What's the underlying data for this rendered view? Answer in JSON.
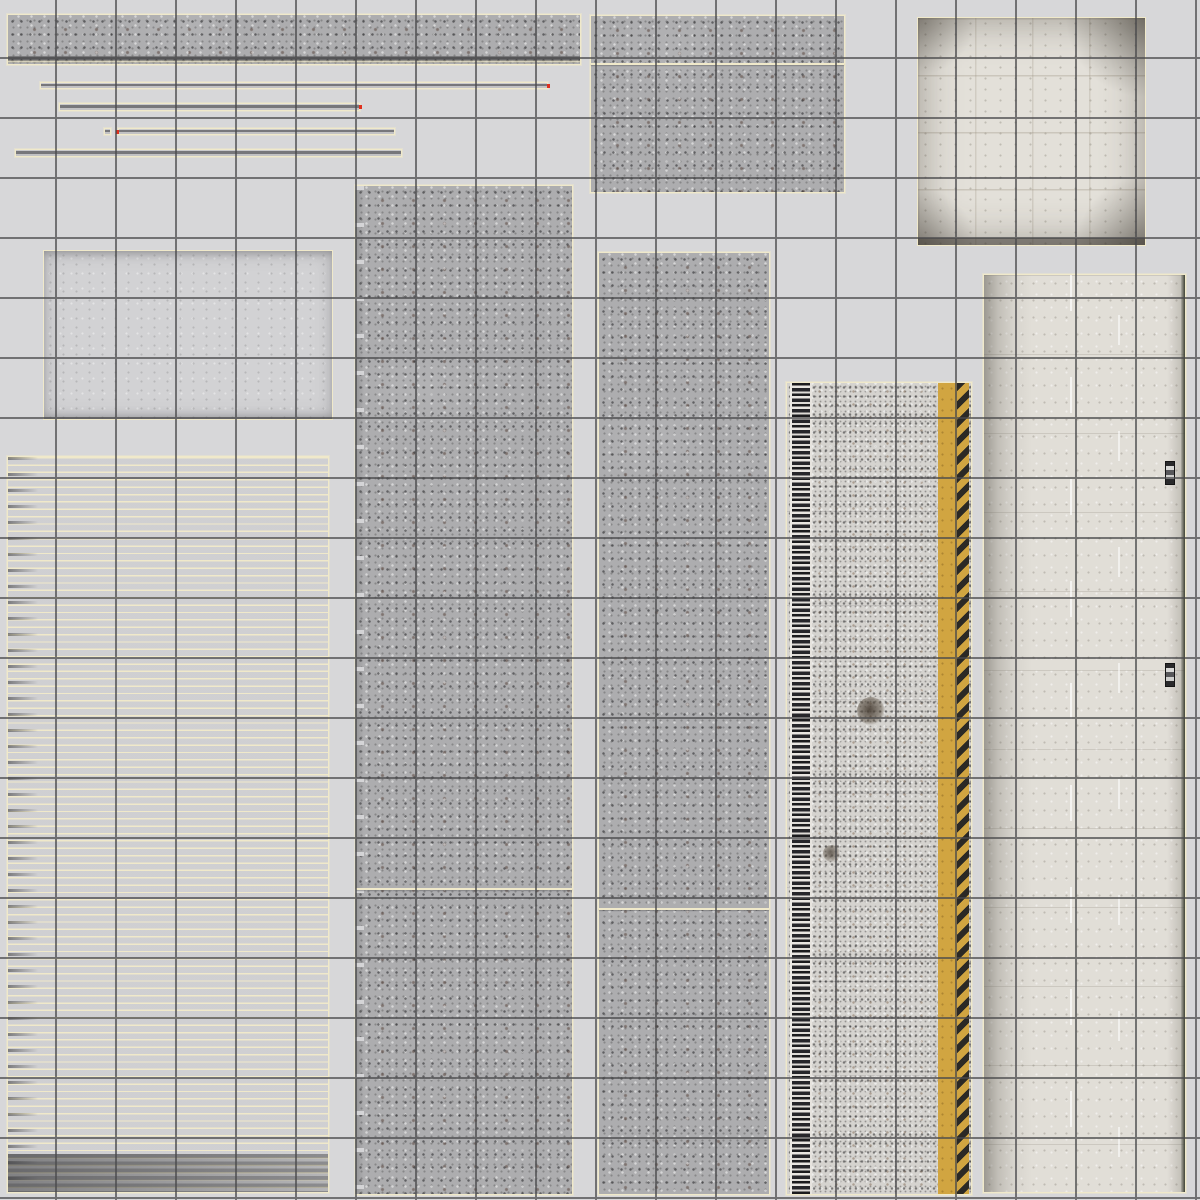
{
  "meta": {
    "type": "texture-atlas",
    "description": "UV texture atlas sheet: concrete barrier, asphalt road and runway-slab textures laid out as outlined islands over a light gray sheet with a dark square reference grid drawn on top. No text is visible in the image.",
    "palette": {
      "background": "#d7d7d9",
      "grid_line": "#4a4a4c",
      "uv_border": "#f0e9ca",
      "seam_tick": "#e0301e",
      "concrete": "#adadaf",
      "concrete_light": "#d2d2d4",
      "block_white": "#e3e0d9",
      "asphalt": "#d5d3cf",
      "paint_yellow": "#d1a541",
      "hazard_black": "#2b2925",
      "edge_green": "#3f4336"
    }
  },
  "grid": {
    "spacing": 60,
    "offset_x": 55,
    "offset_y": 57,
    "line_width": 2
  },
  "islands": [
    {
      "id": "concrete-strip-long-top",
      "texture": "concrete",
      "x": 7,
      "y": 14,
      "w": 574,
      "h": 51,
      "features": [
        "bottom-band"
      ]
    },
    {
      "id": "concrete-block-top-middle",
      "texture": "concrete",
      "x": 590,
      "y": 15,
      "w": 255,
      "h": 178,
      "features": [
        "divider-a"
      ]
    },
    {
      "id": "white-block-square-top-right",
      "texture": "whiteblock",
      "x": 917,
      "y": 17,
      "w": 229,
      "h": 229,
      "features": []
    },
    {
      "id": "rail-strip-1",
      "texture": "thinstrip",
      "x": 40,
      "y": 82,
      "w": 508,
      "h": 7,
      "features": [
        "tick-r"
      ]
    },
    {
      "id": "rail-strip-2",
      "texture": "thinstrip",
      "x": 59,
      "y": 103,
      "w": 301,
      "h": 8,
      "features": [
        "tick-r"
      ]
    },
    {
      "id": "rail-fragment",
      "texture": "thinstrip",
      "x": 104,
      "y": 128,
      "w": 7,
      "h": 7,
      "features": []
    },
    {
      "id": "rail-strip-3",
      "texture": "thinstrip",
      "x": 118,
      "y": 128,
      "w": 277,
      "h": 7,
      "features": [
        "tick-l"
      ]
    },
    {
      "id": "rail-strip-4",
      "texture": "thinstrip",
      "x": 15,
      "y": 149,
      "w": 387,
      "h": 8,
      "features": []
    },
    {
      "id": "light-concrete-rect",
      "texture": "lightrect",
      "x": 43,
      "y": 250,
      "w": 290,
      "h": 170,
      "features": []
    },
    {
      "id": "concrete-column-left",
      "texture": "concrete wavy-left",
      "x": 355,
      "y": 185,
      "w": 218,
      "h": 1010,
      "features": [
        "divider-b"
      ]
    },
    {
      "id": "concrete-column-middle",
      "texture": "concrete",
      "x": 598,
      "y": 252,
      "w": 172,
      "h": 943,
      "features": [
        "divider-c"
      ]
    },
    {
      "id": "striped-rail-sheet",
      "texture": "stripes",
      "x": 7,
      "y": 456,
      "w": 322,
      "h": 737,
      "features": []
    },
    {
      "id": "asphalt-road-column",
      "texture": "asphalt",
      "x": 786,
      "y": 382,
      "w": 186,
      "h": 813,
      "features": [
        "band-ruler",
        "band-yellow",
        "band-hazard",
        "stain-1",
        "stain-2"
      ]
    },
    {
      "id": "runway-slab-column-right",
      "texture": "whitecol",
      "x": 983,
      "y": 274,
      "w": 203,
      "h": 919,
      "features": [
        "white-dash-1",
        "white-dash-2",
        "edge-line",
        "truck-1",
        "truck-2"
      ]
    }
  ]
}
